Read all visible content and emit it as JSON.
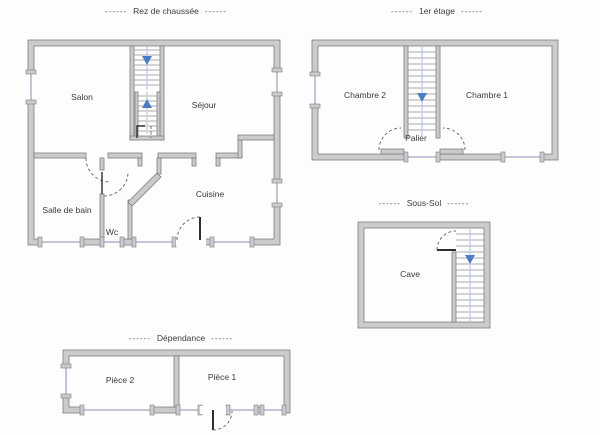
{
  "colors": {
    "background": "#fdfdfd",
    "wall-fill": "#cbcbcb",
    "wall-stroke": "#7d7d7d",
    "window": "#b3b3cf",
    "step": "#8f8f8f",
    "stair-guide": "#b5cbe6",
    "arrow": "#4a7dc3",
    "door-arc": "#5f5f5f",
    "door-leaf": "#2e2e2e",
    "label": "#3a3a3a",
    "title": "#3c3c3c"
  },
  "titles": {
    "dashes": "------",
    "ground_floor": "Rez de chaussée",
    "first_floor": "1er étage",
    "basement": "Sous-Sol",
    "outbuilding": "Dépendance"
  },
  "rooms": {
    "salon": "Salon",
    "sejour": "Séjour",
    "salle_de_bain": "Salle de bain",
    "wc": "Wc",
    "cuisine": "Cuisine",
    "chambre2": "Chambre 2",
    "chambre1": "Chambre 1",
    "palier": "Palier",
    "cave": "Cave",
    "piece2": "Pièce 2",
    "piece1": "Pièce 1"
  },
  "stair_arrows": [
    {
      "plan": "rez-de-chaussee",
      "direction": "down"
    },
    {
      "plan": "rez-de-chaussee",
      "direction": "up"
    },
    {
      "plan": "1er-etage",
      "direction": "down"
    },
    {
      "plan": "sous-sol",
      "direction": "down"
    }
  ]
}
